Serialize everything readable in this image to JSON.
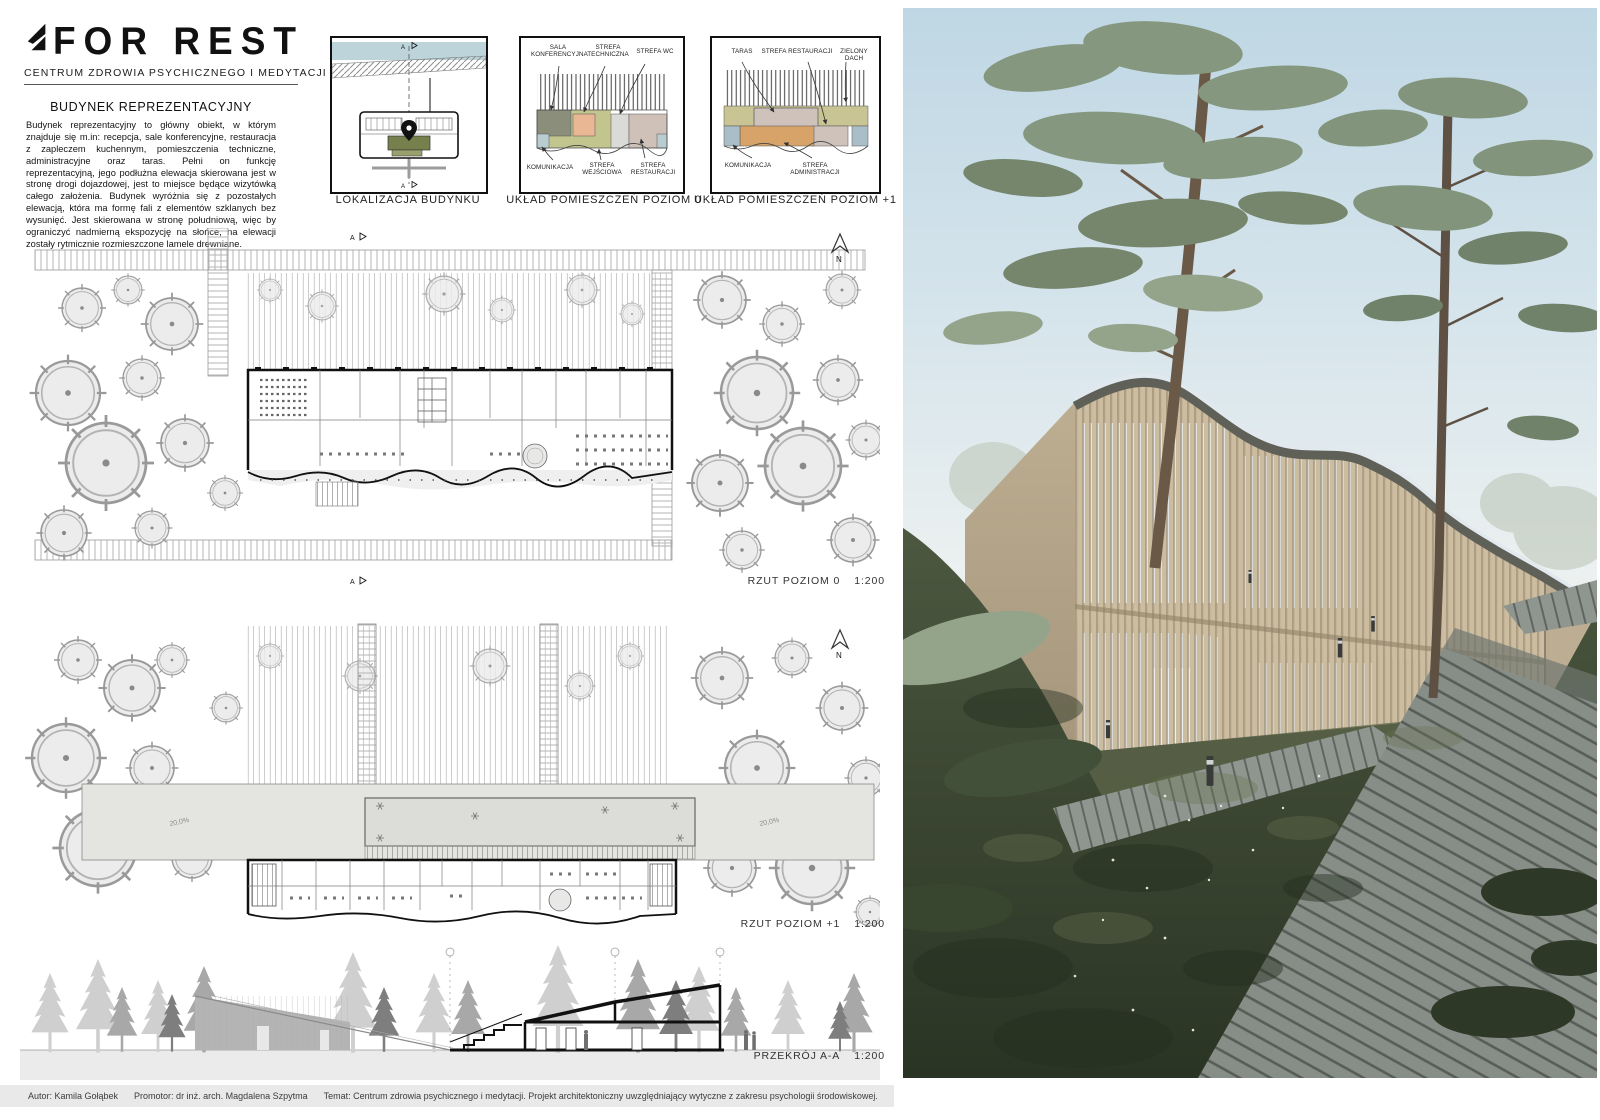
{
  "logo": {
    "title": "FOR REST",
    "tagline": "CENTRUM ZDROWIA PSYCHICZNEGO I MEDYTACJI"
  },
  "intro": {
    "heading": "BUDYNEK REPREZENTACYJNY",
    "body": "Budynek reprezentacyjny to główny obiekt, w którym znajduje się m.in: recepcja, sale konferencyjne, restauracja z zapleczem kuchennym, pomieszczenia techniczne, administracyjne oraz taras. Pełni on funkcję reprezentacyjną, jego podłużna elewacja skierowana jest w stronę drogi dojazdowej, jest to miejsce będące wizytówką całego założenia. Budynek wyróżnia się z pozostałych elewacją, która ma formę fali z elementów szklanych bez wysunięć. Jest skierowana w stronę południową, więc by ograniczyć nadmierną ekspozycję na słońce, na elewacji zostały rytmicznie rozmieszczone lamele drewniane."
  },
  "diagrams": {
    "location": {
      "caption": "LOKALIZACJA BUDYNKU",
      "section_marker": "A"
    },
    "level0": {
      "caption": "UKŁAD POMIESZCZEŃ POZIOM 0",
      "labels": {
        "sala": "SALA KONFERENCYJNA",
        "techniczna": "STREFA TECHNICZNA",
        "wc": "STREFA WC",
        "komunikacja": "KOMUNIKACJA",
        "wejsciowa": "STREFA WEJŚCIOWA",
        "restauracji": "STREFA RESTAURACJI"
      }
    },
    "level1": {
      "caption": "UKŁAD POMIESZCZEŃ POZIOM +1",
      "labels": {
        "taras": "TARAS",
        "restauracji": "STREFA RESTAURACJI",
        "dach": "ZIELONY DACH",
        "komunikacja": "KOMUNIKACJA",
        "administracji": "STREFA ADMINISTRACJI"
      }
    }
  },
  "plans": {
    "level0": {
      "label": "RZUT POZIOM 0",
      "scale": "1:200",
      "north": "N"
    },
    "level1": {
      "label": "RZUT POZIOM +1",
      "scale": "1:200",
      "north": "N",
      "roof_slope": "20,0%"
    },
    "section": {
      "label": "PRZEKRÓJ A-A",
      "scale": "1:200"
    }
  },
  "footer": {
    "author": "Autor: Kamila Gołąbek",
    "promoter": "Promotor: dr inż. arch. Magdalena Szpytma",
    "subject": "Temat: Centrum zdrowia psychicznego i medytacji. Projekt architektoniczny uwzględniający wytyczne z zakresu psychologii środowiskowej.",
    "semester": "Sem. VII",
    "year": "Rok akademicki 2020/21",
    "university": "Politechnika Rzeszowska",
    "sheet": "Plansza 3"
  },
  "colors": {
    "accent_olive": "#76804d",
    "water": "#bcd4da",
    "zone_conference": "#8c8e7c",
    "zone_technical": "#eab795",
    "zone_wc": "#dadad6",
    "zone_circulation": "#b9cdd1",
    "zone_entrance": "#c3c58e",
    "zone_restaurant": "#cfc0b8",
    "zone_admin": "#d8a368",
    "zone_green_roof": "#c9c493",
    "zone_terrace": "#cfc2bb",
    "render_sky": "#c2d9e6",
    "render_wood": "#c9ba9e",
    "render_foliage": "#7d8f79",
    "render_ground": "#3c4733",
    "footer_bg": "#e9e9e9"
  }
}
